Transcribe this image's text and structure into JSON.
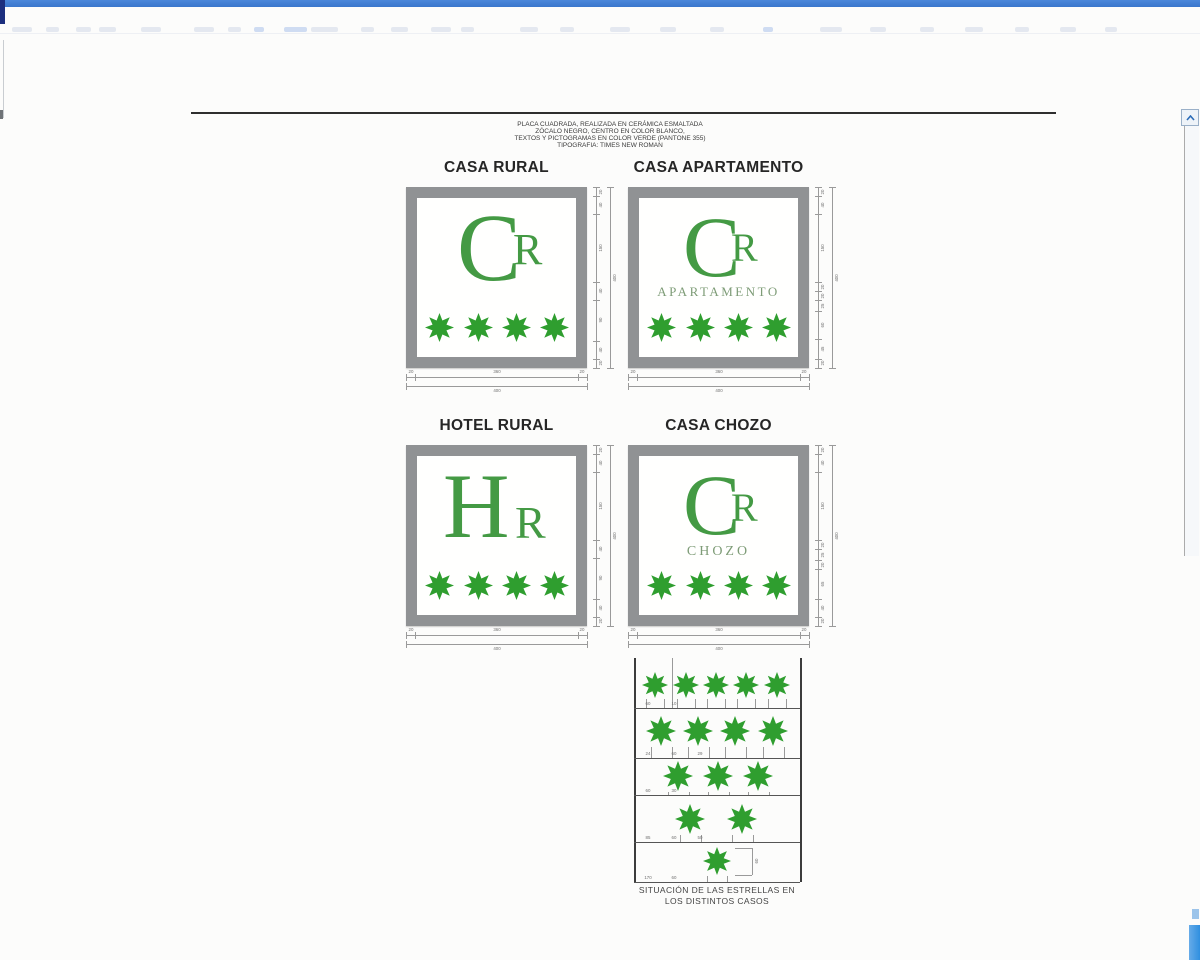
{
  "header": {
    "lines": [
      "PLACA CUADRADA, REALIZADA EN CERÁMICA ESMALTADA",
      "ZÓCALO NEGRO, CENTRO EN COLOR BLANCO,",
      "TEXTOS Y PICTOGRAMAS EN COLOR VERDE (PANTONE 355)",
      "TIPOGRAFIA: TIMES NEW ROMAN"
    ]
  },
  "plaques": [
    {
      "title": "CASA RURAL",
      "monogram_main": "C",
      "monogram_sub": "R",
      "subtitle": "",
      "star_count": 4,
      "dims_right": [
        "20",
        "40",
        "150",
        "40",
        "90",
        "40",
        "20"
      ],
      "dims_right_total": "400",
      "dims_bottom": [
        "20",
        "360",
        "20"
      ],
      "dims_bottom_total": "400"
    },
    {
      "title": "CASA APARTAMENTO",
      "monogram_main": "C",
      "monogram_sub": "R",
      "subtitle": "APARTAMENTO",
      "star_count": 4,
      "dims_right": [
        "20",
        "40",
        "150",
        "20",
        "20",
        "25",
        "60",
        "45",
        "20"
      ],
      "dims_right_total": "400",
      "dims_bottom": [
        "20",
        "360",
        "20"
      ],
      "dims_bottom_total": "400"
    },
    {
      "title": "HOTEL RURAL",
      "monogram_main": "H",
      "monogram_sub": "R",
      "subtitle": "",
      "star_count": 4,
      "dims_right": [
        "20",
        "40",
        "150",
        "40",
        "90",
        "40",
        "20"
      ],
      "dims_right_total": "400",
      "dims_bottom": [
        "20",
        "360",
        "20"
      ],
      "dims_bottom_total": "400"
    },
    {
      "title": "CASA CHOZO",
      "monogram_main": "C",
      "monogram_sub": "R",
      "subtitle": "CHOZO",
      "star_count": 4,
      "dims_right": [
        "20",
        "40",
        "150",
        "20",
        "25",
        "20",
        "65",
        "40",
        "20"
      ],
      "dims_right_total": "400",
      "dims_bottom": [
        "20",
        "360",
        "20"
      ],
      "dims_bottom_total": "400"
    }
  ],
  "star_diagram": {
    "rows": [
      {
        "star_count": 5,
        "labels": [
          "60",
          "10"
        ]
      },
      {
        "star_count": 4,
        "labels": [
          "24",
          "60",
          "29"
        ]
      },
      {
        "star_count": 3,
        "labels": [
          "60",
          "30"
        ]
      },
      {
        "star_count": 2,
        "labels": [
          "85",
          "60",
          "50"
        ]
      },
      {
        "star_count": 1,
        "labels": [
          "170",
          "60"
        ]
      }
    ],
    "side_label": "60",
    "caption_line1": "SITUACIÓN DE LAS ESTRELLAS EN",
    "caption_line2": "LOS DISTINTOS CASOS"
  },
  "colors": {
    "pantone_green": "#2f9e2f",
    "monogram_green": "#449a44",
    "muted_green": "#7e9c77",
    "frame_gray": "#909294",
    "titlebar_blue": "#3a76cc",
    "corner_navy": "#1c2f7e",
    "scroll_blue": "#2f8fe0"
  }
}
